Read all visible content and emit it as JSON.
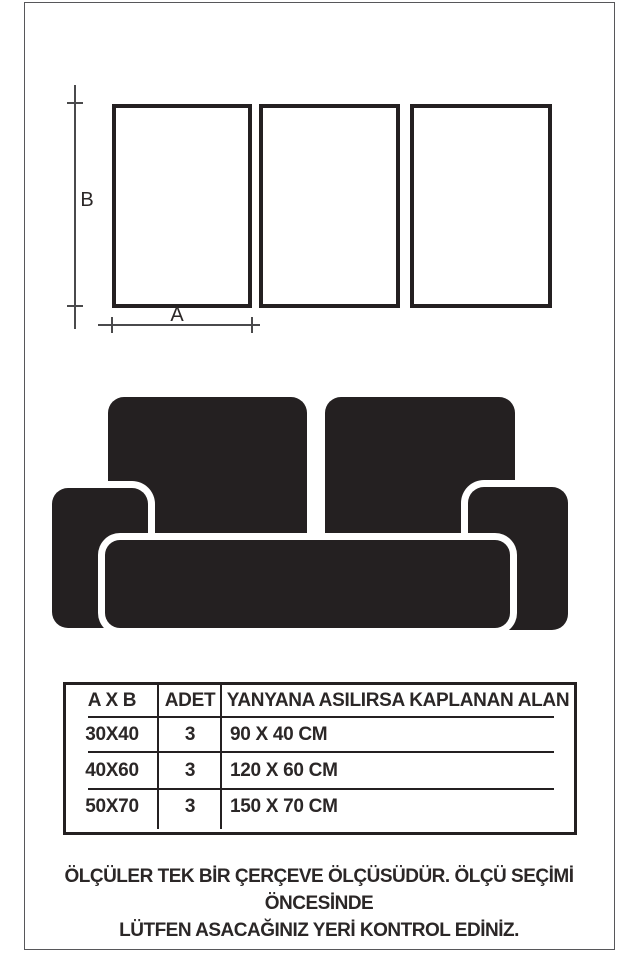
{
  "diagram": {
    "width_label": "A",
    "height_label": "B",
    "frame_count": 3
  },
  "table": {
    "headers": {
      "size": "A X B",
      "qty": "ADET",
      "area": "YANYANA ASILIRSA KAPLANAN ALAN"
    },
    "rows": [
      {
        "size": "30X40",
        "qty": "3",
        "area": "90 X 40 CM"
      },
      {
        "size": "40X60",
        "qty": "3",
        "area": "120 X 60 CM"
      },
      {
        "size": "50X70",
        "qty": "3",
        "area": "150 X 70 CM"
      }
    ]
  },
  "footer": {
    "line1": "ÖLÇÜLER TEK BİR ÇERÇEVE ÖLÇÜSÜDÜR. ÖLÇÜ SEÇİMİ ÖNCESİNDE",
    "line2": "LÜTFEN ASACAĞINIZ YERİ KONTROL EDİNİZ."
  },
  "colors": {
    "ink": "#242021",
    "dimension_line": "#4a4a4c",
    "page_border": "#57575a",
    "background": "#ffffff"
  }
}
